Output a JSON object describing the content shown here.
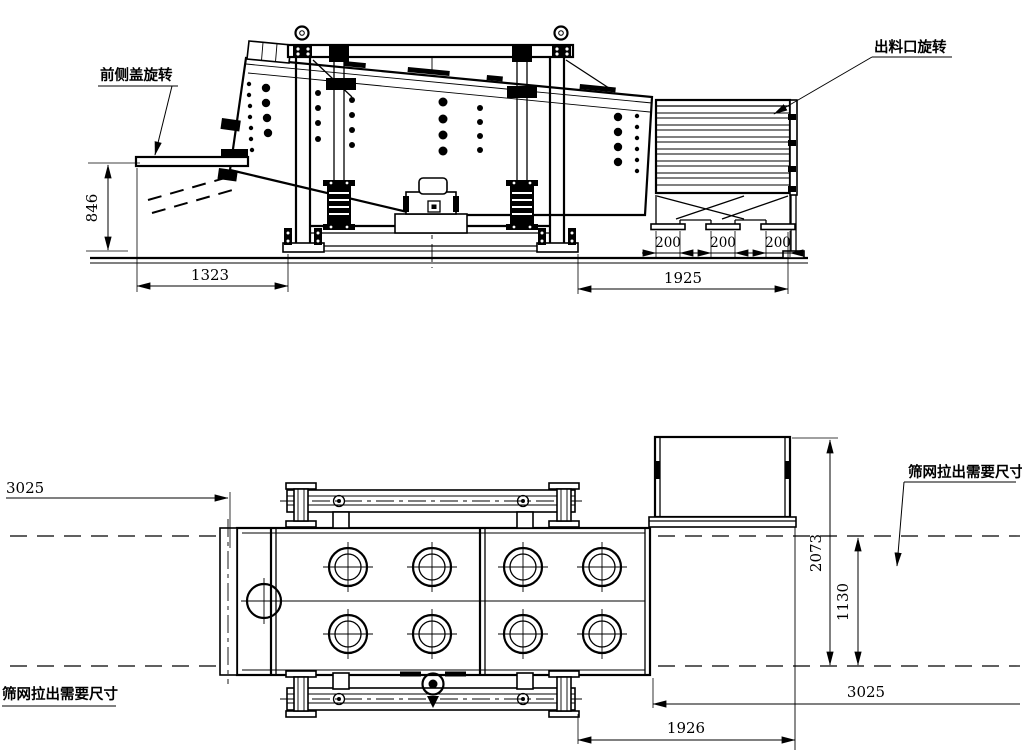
{
  "colors": {
    "background": "#ffffff",
    "line": "#000000"
  },
  "views": {
    "side_elevation": {
      "callouts": {
        "front_cover_rotation": "前侧盖旋转",
        "discharge_port_rotation": "出料口旋转"
      },
      "dimensions": {
        "cover_height": "846",
        "cover_reach": "1323",
        "outlet_widths": [
          "200",
          "200",
          "200"
        ],
        "discharge_length": "1925"
      }
    },
    "plan": {
      "callouts": {
        "mesh_pullout_left": "筛网拉出需要尺寸",
        "mesh_pullout_right": "筛网拉出需要尺寸"
      },
      "dimensions": {
        "pullout_left": "3025",
        "overall_depth": "2073",
        "inner_depth": "1130",
        "pullout_right": "3025",
        "discharge_offset": "1926"
      }
    }
  }
}
